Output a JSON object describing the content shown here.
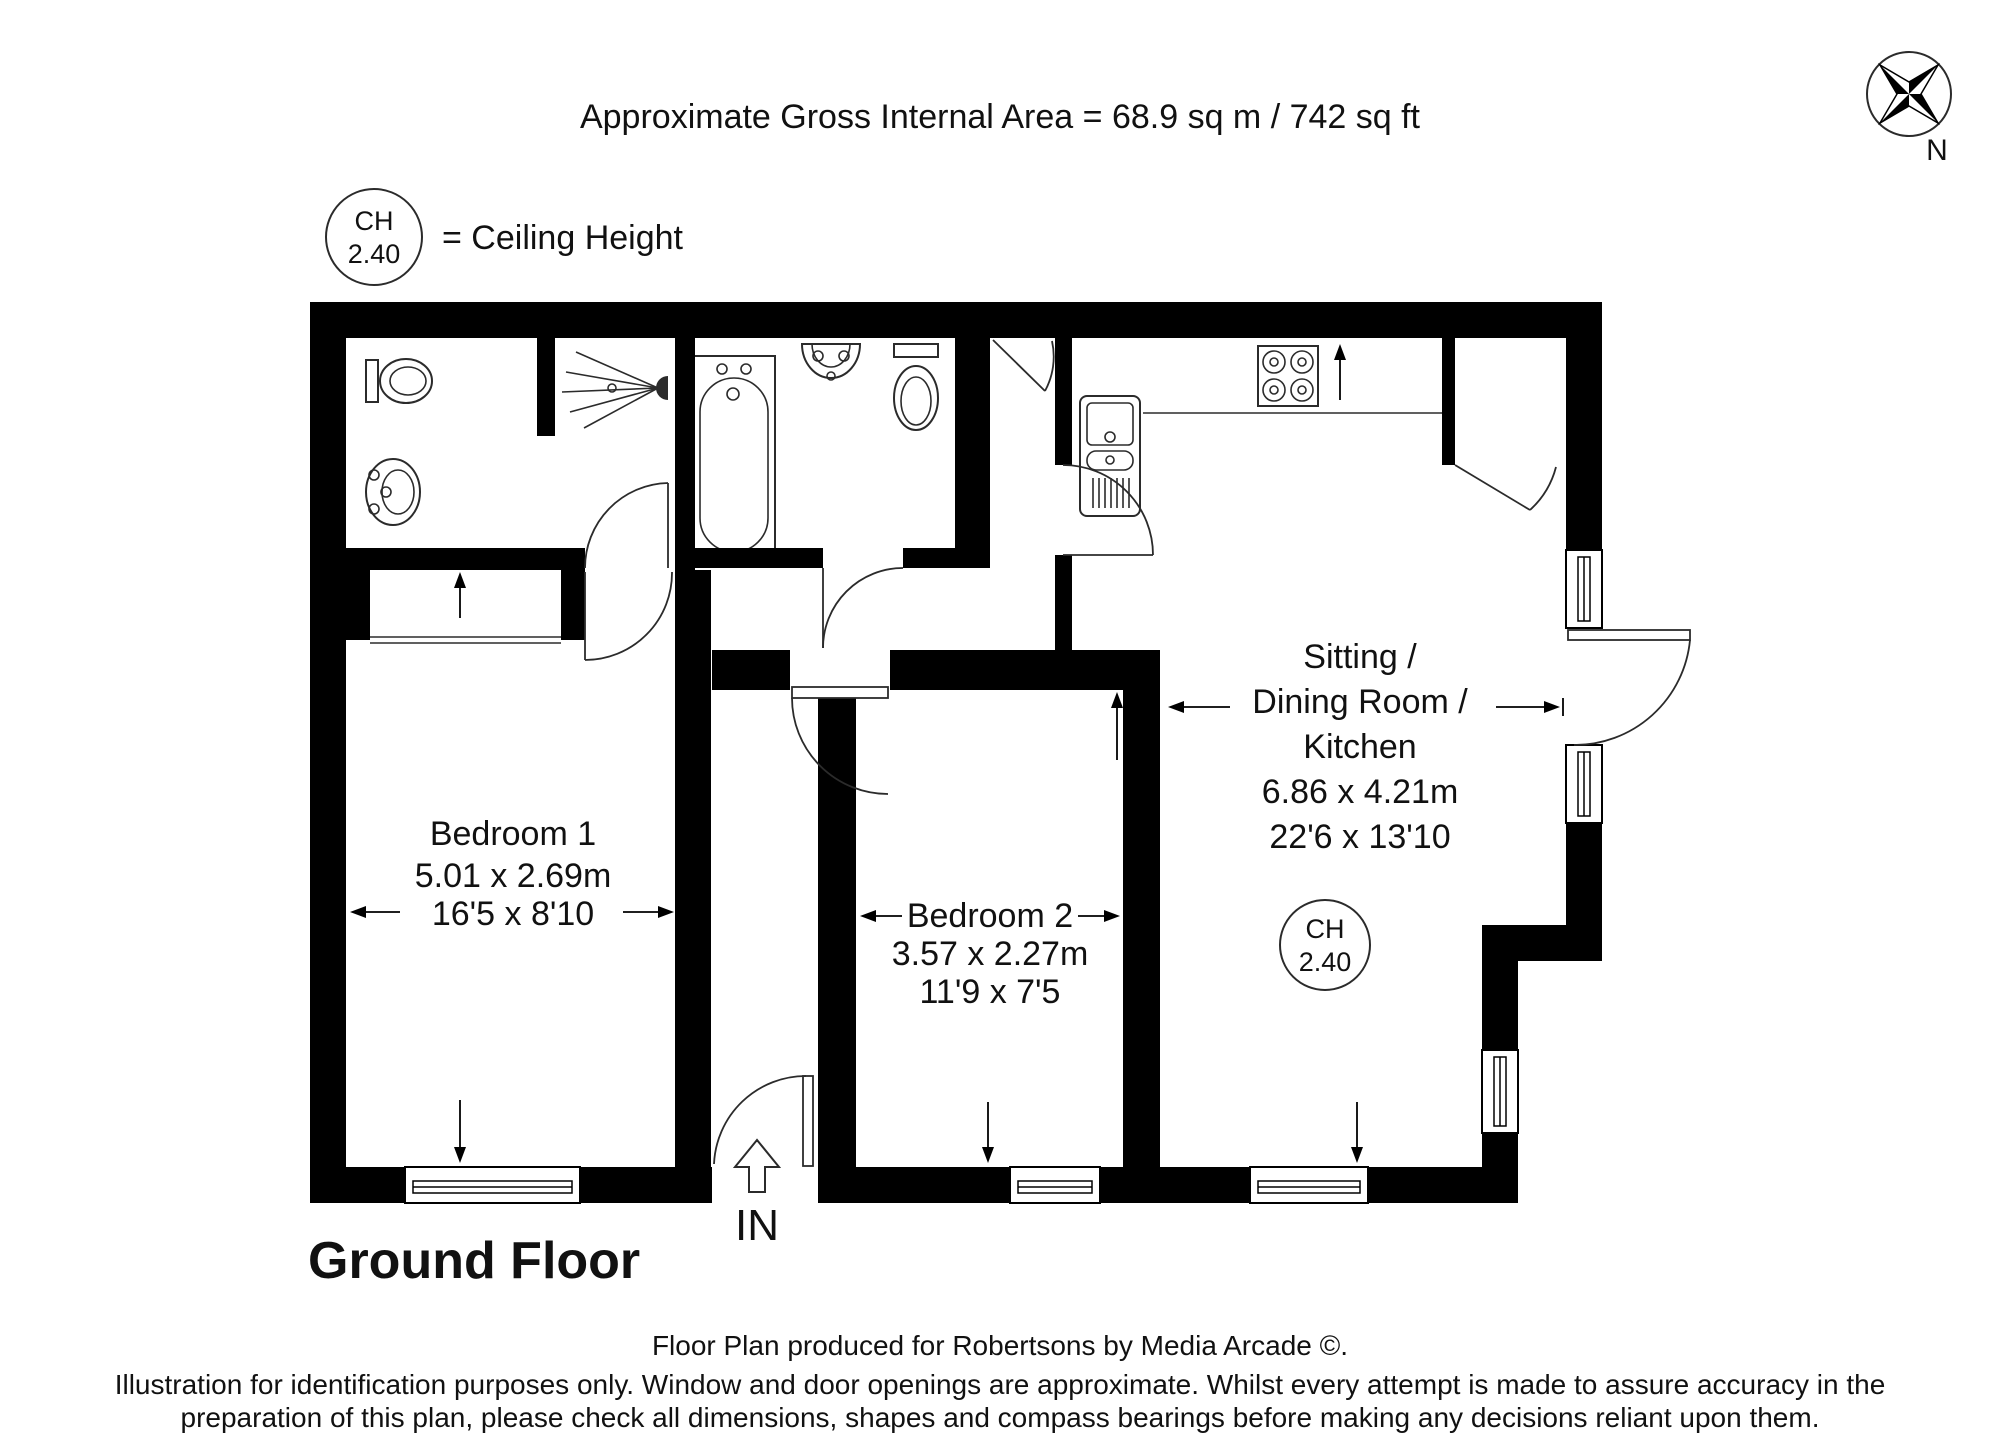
{
  "header": {
    "title": "Approximate Gross Internal Area  = 68.9 sq m / 742 sq ft"
  },
  "legend": {
    "badge_line1": "CH",
    "badge_line2": "2.40",
    "label": "= Ceiling Height"
  },
  "compass": {
    "label": "N"
  },
  "rooms": {
    "bedroom1": {
      "name": "Bedroom 1",
      "metric": "5.01 x 2.69m",
      "imperial": "16'5 x 8'10"
    },
    "bedroom2": {
      "name": "Bedroom 2",
      "metric": "3.57 x 2.27m",
      "imperial": "11'9 x 7'5"
    },
    "sitting": {
      "name_line1": "Sitting  /",
      "name_line2": "Dining Room /",
      "name_line3": "Kitchen",
      "metric": "6.86 x 4.21m",
      "imperial": "22'6 x 13'10",
      "ch_line1": "CH",
      "ch_line2": "2.40"
    }
  },
  "entrance": {
    "label": "IN"
  },
  "floor": {
    "label": "Ground Floor"
  },
  "footer": {
    "line1": "Floor Plan produced for Robertsons by Media Arcade ©.",
    "line2": "Illustration for identification purposes only. Window and door openings are approximate. Whilst every attempt is made to assure accuracy in the",
    "line3": "preparation of this plan, please check all dimensions, shapes and compass bearings before making any decisions reliant upon them."
  },
  "colors": {
    "wall": "#000000",
    "background": "#ffffff",
    "line": "#2b2b2b"
  }
}
